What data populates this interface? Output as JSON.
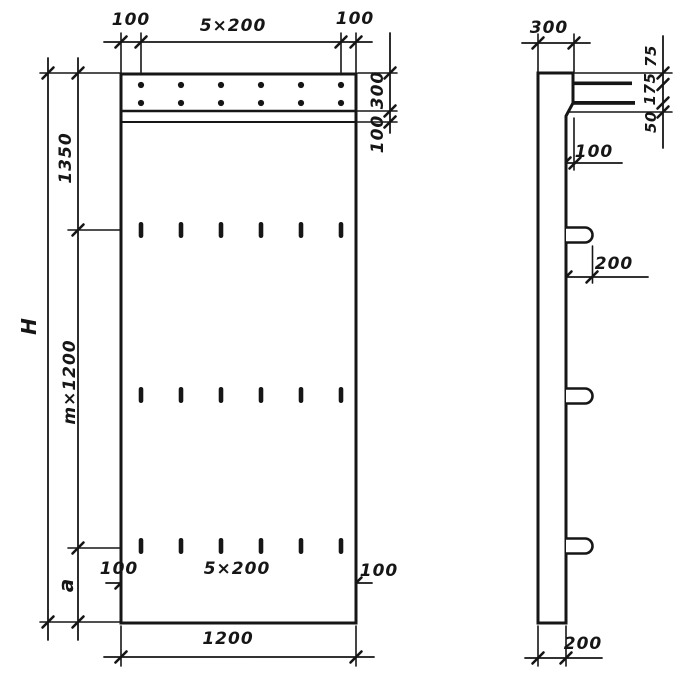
{
  "colors": {
    "ink": "#161616",
    "paper": "#ffffff"
  },
  "front_view": {
    "dim_top_left": "100",
    "dim_top_center": "5×200",
    "dim_top_right": "100",
    "dim_right_band": "300",
    "dim_right_strip": "100",
    "dim_left_total": "H",
    "dim_left_top": "1350",
    "dim_left_middle": "m×1200",
    "dim_left_bottom": "a",
    "dim_bottom_inner_left": "100",
    "dim_bottom_inner_center": "5×200",
    "dim_bottom_inner_right": "100",
    "dim_bottom_width": "1200"
  },
  "side_view": {
    "dim_top_width": "300",
    "dim_edge_top": "75",
    "dim_edge_middle": "175",
    "dim_edge_bottom": "50",
    "dim_face_offset": "100",
    "dim_loop_protrusion": "200",
    "dim_bottom_thickness": "200"
  }
}
